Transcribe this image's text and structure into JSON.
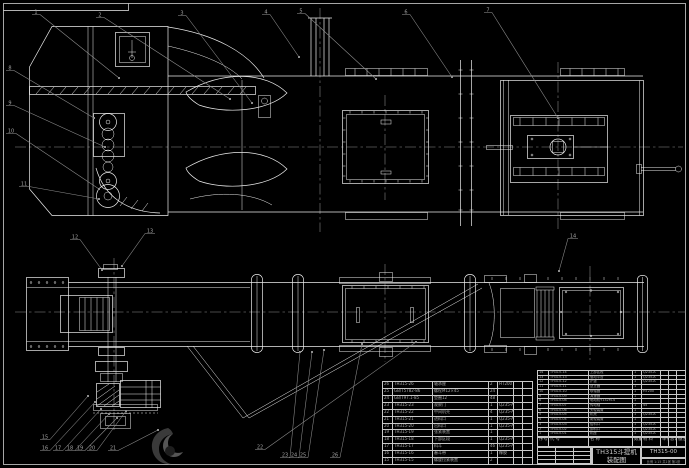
{
  "drawing": {
    "title_line1": "TH315斗提机",
    "title_line2": "装配图",
    "drawing_no": "TH315-00",
    "info_line": "比例 1:15 共1张 第1张"
  },
  "colors": {
    "background": "#000000",
    "line": "#ededed",
    "annotation": "#8f8f8f",
    "table_line": "#c9c9c9",
    "table_text": "#a8a8a8"
  },
  "bom_headers": [
    "序号",
    "代 号",
    "名 称",
    "数量",
    "材 料",
    "单件",
    "总计",
    "备注"
  ],
  "bom_left": [
    [
      "26",
      "TH315-26",
      "轴承座",
      "2",
      "HT200",
      "",
      ""
    ],
    [
      "25",
      "GB/T5782-86",
      "螺栓M12×45",
      "24",
      "",
      "",
      ""
    ],
    [
      "24",
      "GB/T97.1-85",
      "垫圈12",
      "48",
      "",
      "",
      ""
    ],
    [
      "23",
      "TH315-23",
      "观察门",
      "1",
      "Q235-A",
      "",
      ""
    ],
    [
      "22",
      "TH315-22",
      "中间机壳",
      "4",
      "Q235-A",
      "",
      ""
    ],
    [
      "21",
      "TH315-21",
      "进料口",
      "1",
      "Q235-A",
      "",
      ""
    ],
    [
      "20",
      "TH315-20",
      "出料口",
      "1",
      "Q235-A",
      "",
      ""
    ],
    [
      "19",
      "TH315-19",
      "张紧装置",
      "1",
      "",
      "",
      ""
    ],
    [
      "18",
      "TH315-18",
      "下部区段",
      "1",
      "Q235-A",
      "",
      ""
    ],
    [
      "17",
      "TH315-17",
      "料斗",
      "46",
      "Q235-A",
      "",
      ""
    ],
    [
      "16",
      "TH315-16",
      "畚斗带",
      "1",
      "橡胶",
      "",
      ""
    ],
    [
      "15",
      "TH315-15",
      "螺旋拉紧装置",
      "2",
      "",
      "",
      ""
    ]
  ],
  "bom_right": [
    [
      "14",
      "TH315-14",
      "上部区段",
      "1",
      "Q235-A",
      "",
      "",
      ""
    ],
    [
      "13",
      "TH315-13",
      "驱动平台",
      "1",
      "Q235-A",
      "",
      "",
      ""
    ],
    [
      "12",
      "TH315-12",
      "护罩",
      "1",
      "Q235-A",
      "",
      "",
      ""
    ],
    [
      "11",
      "TH315-11",
      "逆止器",
      "1",
      "",
      "",
      "",
      ""
    ],
    [
      "10",
      "TH315-10",
      "联轴器",
      "1",
      "HT200",
      "",
      "",
      ""
    ],
    [
      "9",
      "TH315-09",
      "减速器",
      "1",
      "",
      "",
      "",
      ""
    ],
    [
      "8",
      "TH315-08",
      "电动机Y132M-4",
      "1",
      "",
      "",
      "",
      ""
    ],
    [
      "7",
      "TH315-07",
      "传动轴",
      "1",
      "45",
      "",
      "",
      ""
    ],
    [
      "6",
      "TH315-06",
      "头轮装置",
      "1",
      "",
      "",
      "",
      ""
    ],
    [
      "5",
      "TH315-05",
      "机壳",
      "1",
      "Q235-A",
      "",
      "",
      ""
    ],
    [
      "4",
      "TH315-04",
      "尾轮装置",
      "1",
      "",
      "",
      "",
      ""
    ],
    [
      "3",
      "TH315-03",
      "给料口",
      "1",
      "Q235-A",
      "",
      "",
      ""
    ],
    [
      "2",
      "TH315-02",
      "卸料口",
      "1",
      "Q235-A",
      "",
      "",
      ""
    ],
    [
      "1",
      "TH315-01",
      "机座",
      "1",
      "Q235-A",
      "",
      "",
      ""
    ]
  ],
  "balloons": [
    {
      "n": "1",
      "x": 33,
      "y": 9,
      "tx": 119,
      "ty": 78
    },
    {
      "n": "2",
      "x": 97,
      "y": 12,
      "tx": 230,
      "ty": 99
    },
    {
      "n": "3",
      "x": 179,
      "y": 10,
      "tx": 252,
      "ty": 103
    },
    {
      "n": "4",
      "x": 263,
      "y": 9,
      "tx": 299,
      "ty": 57
    },
    {
      "n": "5",
      "x": 298,
      "y": 8,
      "tx": 376,
      "ty": 79
    },
    {
      "n": "6",
      "x": 403,
      "y": 9,
      "tx": 452,
      "ty": 77
    },
    {
      "n": "7",
      "x": 485,
      "y": 7,
      "tx": 558,
      "ty": 118
    },
    {
      "n": "8",
      "x": 7,
      "y": 65,
      "tx": 94,
      "ty": 118
    },
    {
      "n": "9",
      "x": 7,
      "y": 100,
      "tx": 105,
      "ty": 147
    },
    {
      "n": "10",
      "x": 7,
      "y": 128,
      "tx": 99,
      "ty": 189
    },
    {
      "n": "11",
      "x": 20,
      "y": 181,
      "tx": 99,
      "ty": 199
    },
    {
      "n": "12",
      "x": 71,
      "y": 234,
      "tx": 102,
      "ty": 270
    },
    {
      "n": "13",
      "x": 146,
      "y": 228,
      "tx": 122,
      "ty": 266
    },
    {
      "n": "14",
      "x": 569,
      "y": 233,
      "tx": 559,
      "ty": 271
    },
    {
      "n": "15",
      "x": 41,
      "y": 434,
      "tx": 88,
      "ty": 396
    },
    {
      "n": "16",
      "x": 41,
      "y": 445,
      "tx": 95,
      "ty": 402
    },
    {
      "n": "17",
      "x": 54,
      "y": 445,
      "tx": 101,
      "ty": 409
    },
    {
      "n": "18",
      "x": 66,
      "y": 445,
      "tx": 109,
      "ty": 414
    },
    {
      "n": "19",
      "x": 76,
      "y": 445,
      "tx": 117,
      "ty": 418
    },
    {
      "n": "20",
      "x": 88,
      "y": 445,
      "tx": 126,
      "ty": 411
    },
    {
      "n": "21",
      "x": 109,
      "y": 445,
      "tx": 158,
      "ty": 430
    },
    {
      "n": "22",
      "x": 256,
      "y": 444,
      "tx": 416,
      "ty": 342
    },
    {
      "n": "23",
      "x": 281,
      "y": 452,
      "tx": 300,
      "ty": 352
    },
    {
      "n": "24",
      "x": 290,
      "y": 452,
      "tx": 312,
      "ty": 352
    },
    {
      "n": "25",
      "x": 299,
      "y": 452,
      "tx": 324,
      "ty": 350
    },
    {
      "n": "26",
      "x": 331,
      "y": 452,
      "tx": 362,
      "ty": 344
    }
  ]
}
